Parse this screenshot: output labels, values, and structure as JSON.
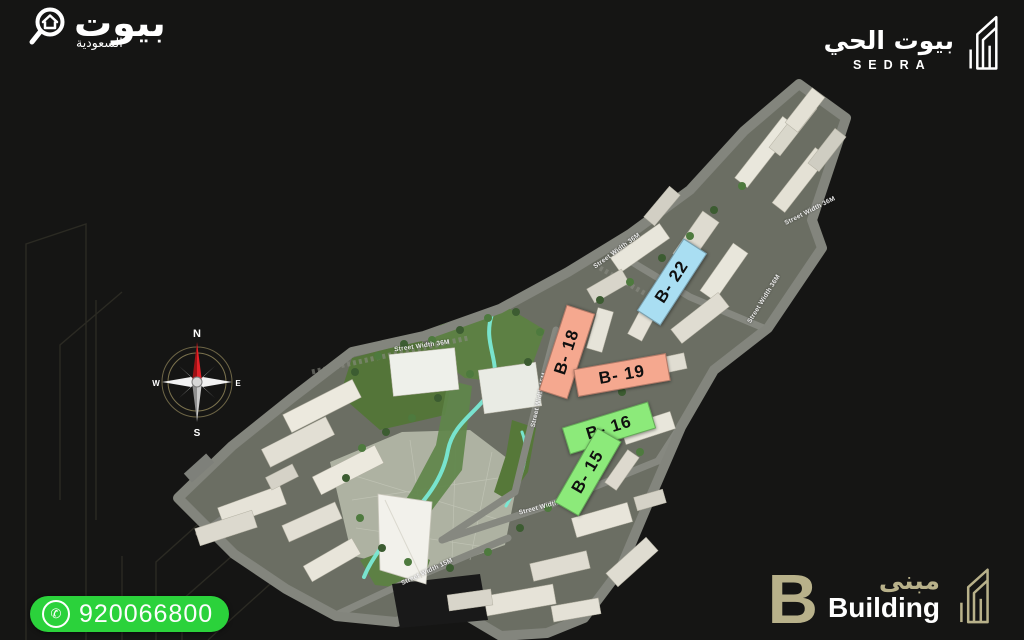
{
  "brand_left": {
    "logo_icon": "magnifier-home-icon",
    "name_ar": "بيوت",
    "subtitle_ar": "السعودية"
  },
  "brand_right": {
    "logo_icon": "building-outline-icon",
    "name_ar": "بيوت الحي",
    "project_name": "SEDRA"
  },
  "compass": {
    "north": "N",
    "east": "E",
    "south": "S",
    "west": "W",
    "needle_color": "#e22128"
  },
  "map": {
    "buildings": [
      {
        "id": "b22",
        "label": "B- 22",
        "color": "#a9def2"
      },
      {
        "id": "b18",
        "label": "B- 18",
        "color": "#f5a88f"
      },
      {
        "id": "b19",
        "label": "B- 19",
        "color": "#f5a88f"
      },
      {
        "id": "b16",
        "label": "B- 16",
        "color": "#8cea7a"
      },
      {
        "id": "b15",
        "label": "B- 15",
        "color": "#8cea7a"
      }
    ],
    "street_labels": [
      {
        "label": "Street Width 36M"
      },
      {
        "label": "Street Width 36M"
      },
      {
        "label": "Street Width 36M"
      },
      {
        "label": "Street Width 36M"
      },
      {
        "label": "Street Width 15M"
      },
      {
        "label": "Street Width 15M"
      },
      {
        "label": "Street Width 15M"
      }
    ]
  },
  "legend": {
    "letter": "B",
    "label_ar": "مبنى",
    "label_en": "Building",
    "accent_color": "#b8b18a",
    "icon": "building-outline-icon"
  },
  "contact": {
    "phone": "920066800",
    "icon": "phone-icon",
    "icon_glyph": "✆",
    "pill_color": "#2bd23b"
  }
}
